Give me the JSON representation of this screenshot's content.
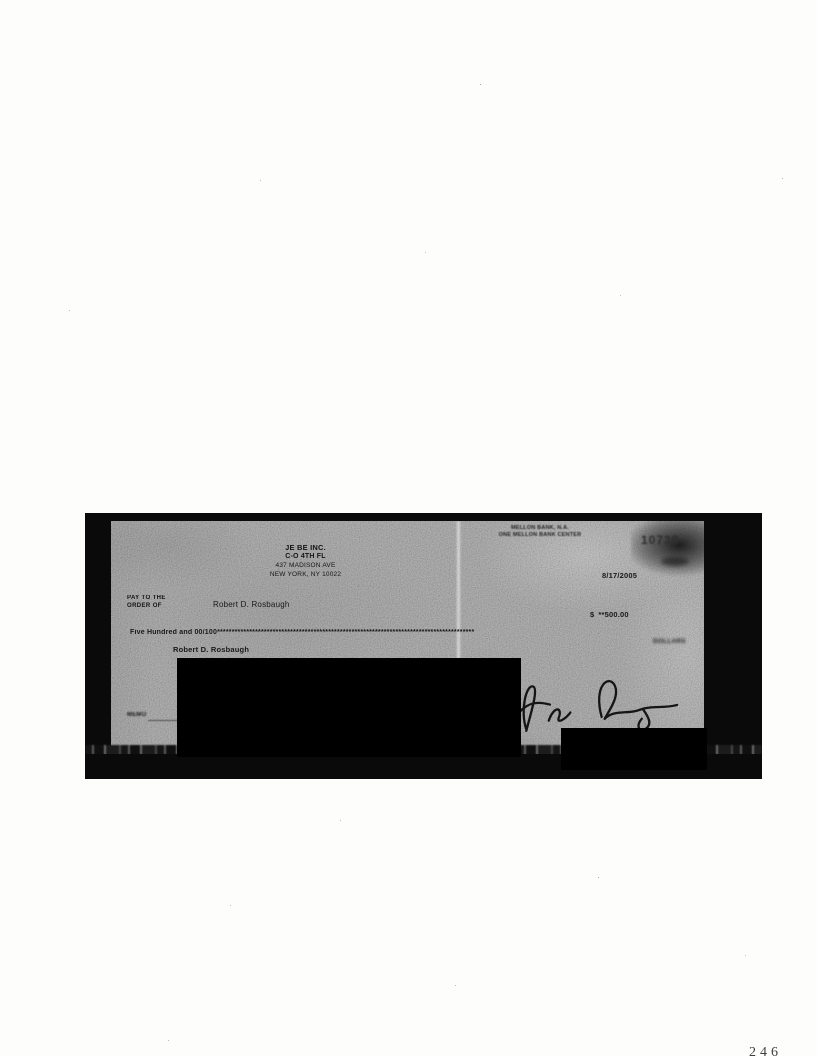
{
  "page": {
    "number_partial": "246"
  },
  "scan": {
    "bank": {
      "line1": "MELLON BANK, N.A.",
      "line2": "ONE MELLON BANK CENTER"
    },
    "check_number": "10739",
    "date": "8/17/2005",
    "payer": {
      "name": "JE BE INC.",
      "address1": "C-O 4TH FL",
      "address2": "437 MADISON AVE",
      "address3": "NEW YORK, NY 10022"
    },
    "pay_to": {
      "label_line1": "PAY TO THE",
      "label_line2": "ORDER OF",
      "payee": "Robert D. Rosbaugh"
    },
    "amount": {
      "currency_symbol": "$",
      "numeric": "**500.00",
      "words": "Five Hundred and 00/100",
      "asterisk_fill": "****************************************************************************************",
      "dollars_label": "DOLLARS"
    },
    "address_block": {
      "name": "Robert D. Rosbaugh"
    },
    "memo_label": "MEMO",
    "colors": {
      "scan_gray": "#8d8d8d",
      "frame_black": "#0a0a0a",
      "ink": "#191919"
    }
  }
}
